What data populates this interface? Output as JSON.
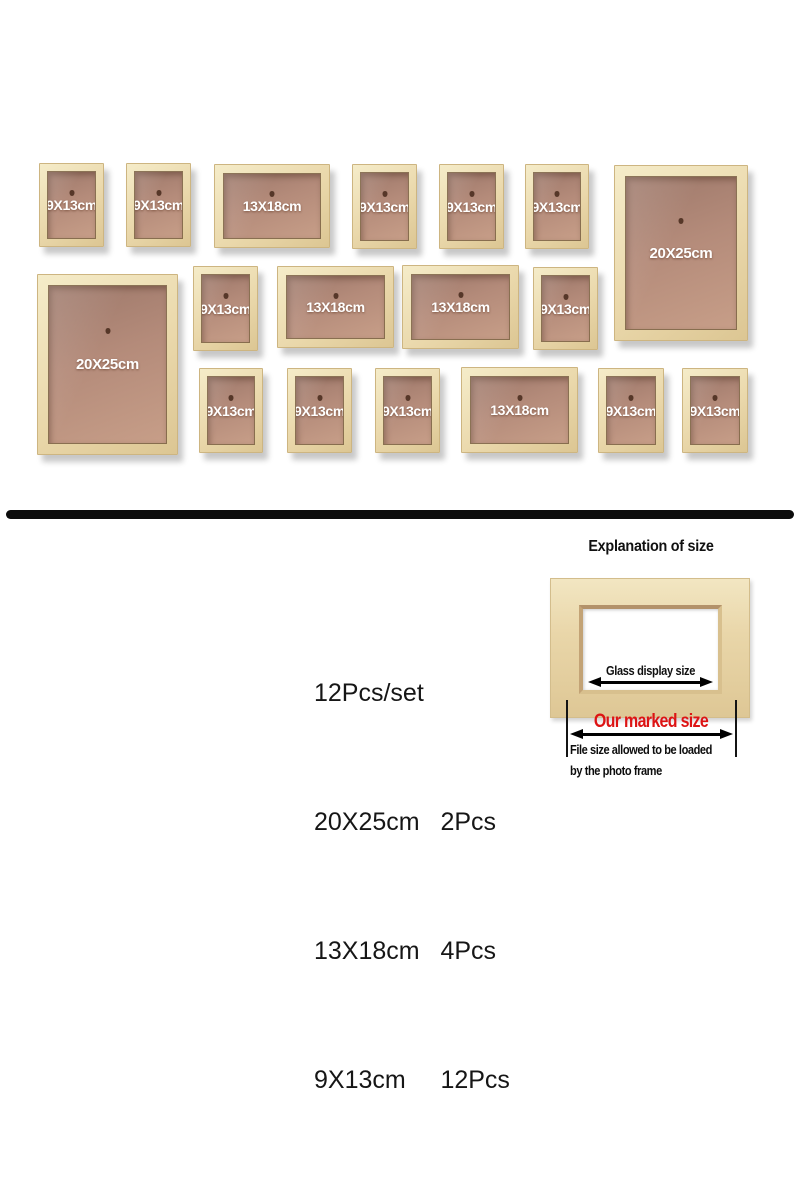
{
  "colors": {
    "background": "#ffffff",
    "wood_light": "#f5ecc9",
    "wood_base": "#ead8ab",
    "wood_dark": "#dcc693",
    "wood_edge": "#cdb581",
    "backing_dark": "#9d786a",
    "backing_mid": "#b48b7a",
    "backing_light": "#c79e88",
    "divider": "#0c0c0c",
    "red_accent": "#dd1414"
  },
  "wall": {
    "frames": [
      {
        "label": "9X13cm",
        "size": "s",
        "x": 39,
        "y": 163,
        "w": 65,
        "h": 84
      },
      {
        "label": "9X13cm",
        "size": "s",
        "x": 126,
        "y": 163,
        "w": 65,
        "h": 84
      },
      {
        "label": "13X18cm",
        "size": "m",
        "x": 214,
        "y": 164,
        "w": 116,
        "h": 84
      },
      {
        "label": "9X13cm",
        "size": "s",
        "x": 352,
        "y": 164,
        "w": 65,
        "h": 85
      },
      {
        "label": "9X13cm",
        "size": "s",
        "x": 439,
        "y": 164,
        "w": 65,
        "h": 85
      },
      {
        "label": "9X13cm",
        "size": "s",
        "x": 525,
        "y": 164,
        "w": 64,
        "h": 85
      },
      {
        "label": "20X25cm",
        "size": "l",
        "x": 614,
        "y": 165,
        "w": 134,
        "h": 176
      },
      {
        "label": "20X25cm",
        "size": "l",
        "x": 37,
        "y": 274,
        "w": 141,
        "h": 181
      },
      {
        "label": "9X13cm",
        "size": "s",
        "x": 193,
        "y": 266,
        "w": 65,
        "h": 85
      },
      {
        "label": "13X18cm",
        "size": "m",
        "x": 277,
        "y": 266,
        "w": 117,
        "h": 82
      },
      {
        "label": "13X18cm",
        "size": "m",
        "x": 402,
        "y": 265,
        "w": 117,
        "h": 84
      },
      {
        "label": "9X13cm",
        "size": "s",
        "x": 533,
        "y": 267,
        "w": 65,
        "h": 83
      },
      {
        "label": "9X13cm",
        "size": "s",
        "x": 199,
        "y": 368,
        "w": 64,
        "h": 85
      },
      {
        "label": "9X13cm",
        "size": "s",
        "x": 287,
        "y": 368,
        "w": 65,
        "h": 85
      },
      {
        "label": "9X13cm",
        "size": "s",
        "x": 375,
        "y": 368,
        "w": 65,
        "h": 85
      },
      {
        "label": "13X18cm",
        "size": "m",
        "x": 461,
        "y": 367,
        "w": 117,
        "h": 86
      },
      {
        "label": "9X13cm",
        "size": "s",
        "x": 598,
        "y": 368,
        "w": 66,
        "h": 85
      },
      {
        "label": "9X13cm",
        "size": "s",
        "x": 682,
        "y": 368,
        "w": 66,
        "h": 85
      }
    ]
  },
  "summary": {
    "lines": [
      "12Pcs/set",
      "20X25cm   2Pcs",
      "13X18cm   4Pcs",
      "9X13cm     12Pcs"
    ]
  },
  "explanation": {
    "title": "Explanation of size",
    "glass_label": "Glass display size",
    "marked_size_label": "Our marked size",
    "file_note_line1": "File size allowed to be loaded",
    "file_note_line2": "by the photo frame"
  }
}
